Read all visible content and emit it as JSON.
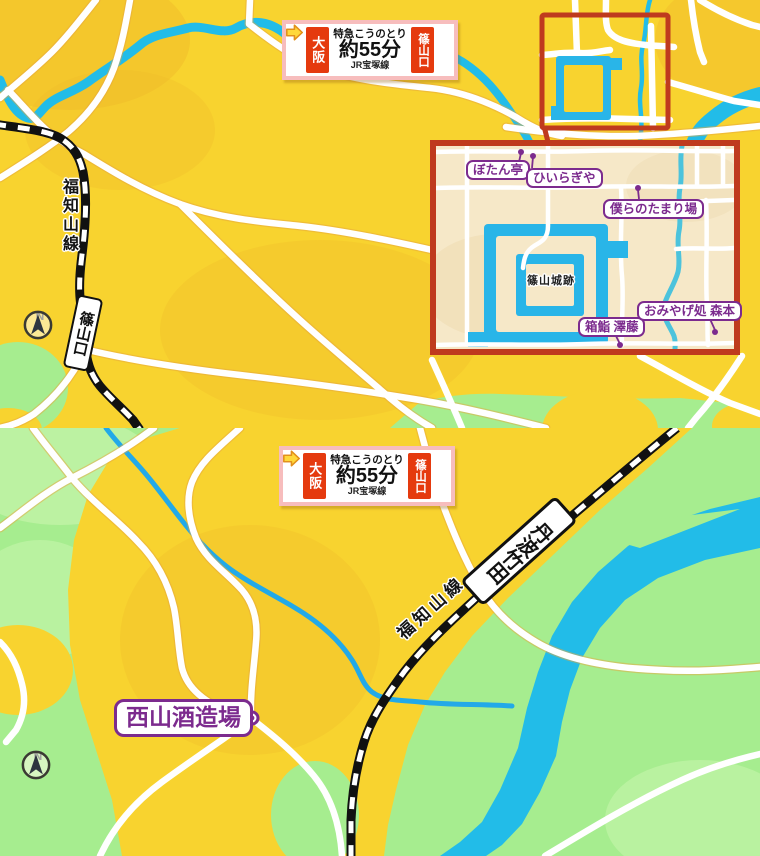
{
  "route_banner": {
    "from": "大阪",
    "to": "篠山口",
    "train_name": "特急こうのとり",
    "duration": "約55分",
    "line_name": "JR宝塚線"
  },
  "top_map": {
    "railway": "福知山線",
    "station": "篠山口",
    "compass_n": "N",
    "inset_labels": {
      "castle": "篠山城跡",
      "botan": "ぼたん亭",
      "hiiragiya": "ひいらぎや",
      "tamariba": "僕らのたまり場",
      "hakozushi": "箱鮨 澤藤",
      "miyage": "おみやげ処 森本"
    }
  },
  "bottom_map": {
    "railway": "福知山線",
    "station": "丹波竹田",
    "brewery": "西山酒造場",
    "compass_n": "N"
  },
  "palette": {
    "land_yellow": "#F8D32F",
    "land_deep_yellow": "#EFB82A",
    "land_green": "#A6ED8F",
    "land_light_green": "#C2F3A6",
    "river_blue": "#22BCE8",
    "moat_blue": "#29B5E8",
    "road_white": "#FFFFFF",
    "railway_black": "#111111",
    "frame_red": "#BF3A1E",
    "banner_red": "#E53A0E",
    "banner_pink_border": "#F7BDBD",
    "arrow_yellow": "#FFD83A",
    "poi_purple": "#7C2B8E",
    "inset_cream": "#F6E8C8"
  }
}
